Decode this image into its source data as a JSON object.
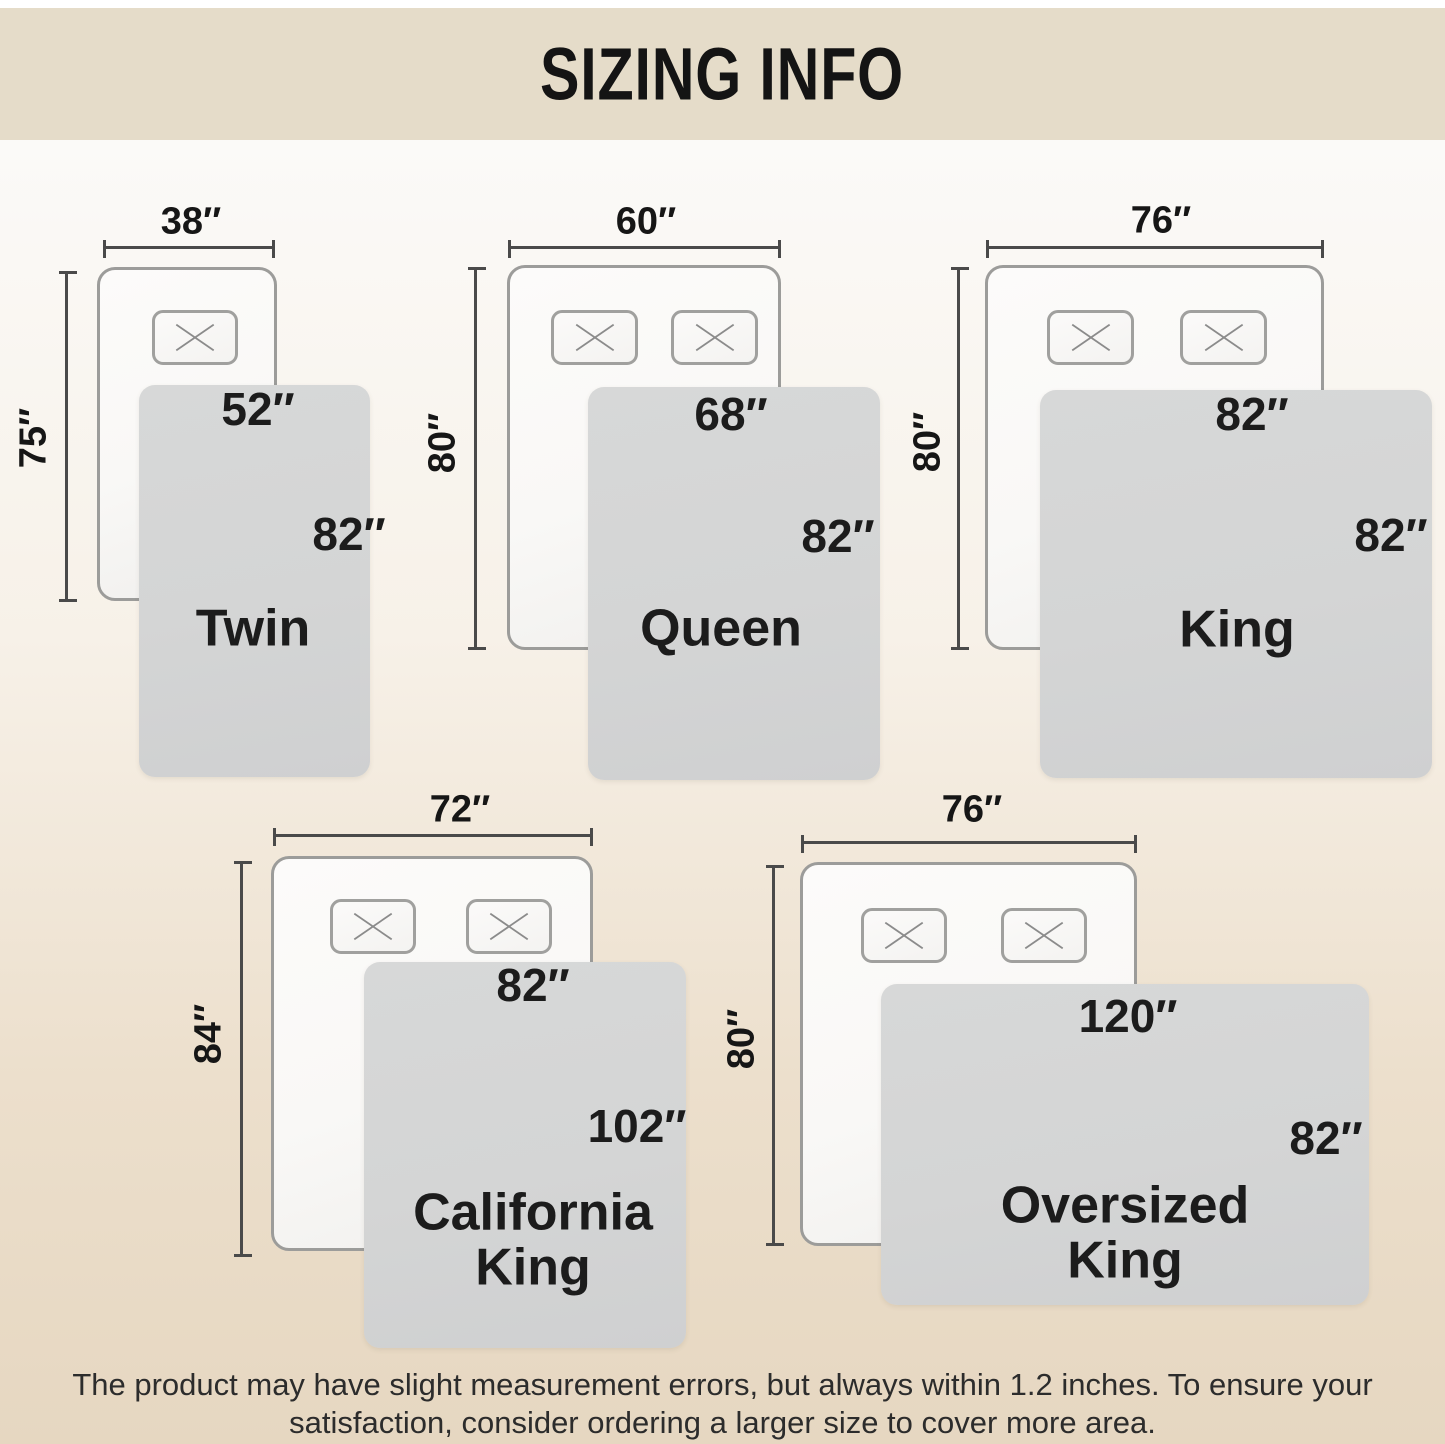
{
  "header": {
    "title": "SIZING INFO"
  },
  "diagrams": [
    {
      "name_line1": "Twin",
      "name_line2": "",
      "mattress_width": "38″",
      "mattress_length": "75″",
      "blanket_width": "52″",
      "blanket_length": "82″",
      "pillows": 1
    },
    {
      "name_line1": "Queen",
      "name_line2": "",
      "mattress_width": "60″",
      "mattress_length": "80″",
      "blanket_width": "68″",
      "blanket_length": "82″",
      "pillows": 2
    },
    {
      "name_line1": "King",
      "name_line2": "",
      "mattress_width": "76″",
      "mattress_length": "80″",
      "blanket_width": "82″",
      "blanket_length": "82″",
      "pillows": 2
    },
    {
      "name_line1": "California",
      "name_line2": "King",
      "mattress_width": "72″",
      "mattress_length": "84″",
      "blanket_width": "82″",
      "blanket_length": "102″",
      "pillows": 2
    },
    {
      "name_line1": "Oversized",
      "name_line2": "King",
      "mattress_width": "76″",
      "mattress_length": "80″",
      "blanket_width": "120″",
      "blanket_length": "82″",
      "pillows": 2
    }
  ],
  "footer": {
    "line1": "The product may have slight measurement errors, but always within 1.2 inches. To ensure your",
    "line2": "satisfaction, consider ordering a larger size to cover more area."
  },
  "colors": {
    "header_band": "#e5dcc9",
    "background_top": "#fbfaf8",
    "background_bottom": "#e6d7c1",
    "blanket": "#d4d5d5",
    "mattress": "#f9f8f6",
    "mattress_border": "#9c9c9a",
    "dimension_line": "#4a4a4a",
    "text": "#1a1a1a"
  }
}
